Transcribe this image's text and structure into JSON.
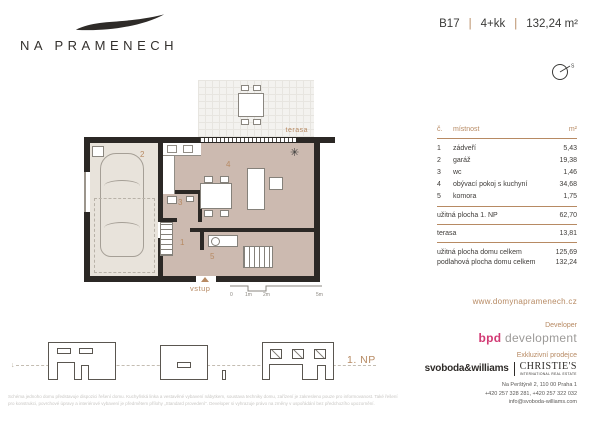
{
  "colors": {
    "accent": "#b78a63",
    "dark_text": "#3a3a38",
    "wall": "#2b2825",
    "floor_living": "#ccbab0",
    "floor_garage": "#e8e3db",
    "bpd_pink": "#d23a74",
    "gray_text": "#9c9a98"
  },
  "header": {
    "logo_text": "NA PRAMENECH",
    "unit": "B17",
    "sep": "|",
    "layout": "4+kk",
    "area": "132,24 m²",
    "compass_north": "S"
  },
  "floor_plan": {
    "terrace_label": "terasa",
    "entrance_label": "vstup",
    "room_numbers": [
      "1",
      "2",
      "3",
      "4",
      "5"
    ],
    "scale_labels": [
      "0",
      "1m",
      "2m",
      "5m"
    ]
  },
  "room_table": {
    "headers": {
      "number": "č.",
      "name": "místnost",
      "area": "m²"
    },
    "rows": [
      {
        "number": "1",
        "name": "zádveří",
        "area": "5,43"
      },
      {
        "number": "2",
        "name": "garáž",
        "area": "19,38"
      },
      {
        "number": "3",
        "name": "wc",
        "area": "1,46"
      },
      {
        "number": "4",
        "name": "obývací pokoj s kuchyní",
        "area": "34,68"
      },
      {
        "number": "5",
        "name": "komora",
        "area": "1,75"
      }
    ],
    "subtotal_np": {
      "name": "užitná plocha 1. NP",
      "area": "62,70"
    },
    "subtotal_terrace": {
      "name": "terasa",
      "area": "13,81"
    },
    "total_usable": {
      "name": "užitná plocha domu celkem",
      "area": "125,69"
    },
    "total_floor": {
      "name": "podlahová plocha domu celkem",
      "area": "132,24"
    }
  },
  "elevations": {
    "floor_label": "1. NP"
  },
  "footer": {
    "website": "www.domynapramenech.cz",
    "developer_label": "Developer",
    "developer_bpd": "bpd",
    "developer_rest": " development",
    "seller_label": "Exkluzivní prodejce",
    "seller_sw": "svoboda&williams",
    "seller_christies": "CHRISTIE'S",
    "seller_christies_sub": "INTERNATIONAL REAL ESTATE",
    "address": "Na Perštýně 2, 110 00 Praha 1",
    "phones": "+420 257 328 281, +420 257 322 032",
    "email": "info@svoboda-williams.com"
  },
  "disclaimer": {
    "line1": "Schéma jednoho domu představuje dispozici řešení domu. Kuchyňská linka a vestavěné vybavení nábytkem, soustava techniky domu, zařízení je zakresleno pouze pro informovanost. Také řešení",
    "line2": "pro konstrukci, povrchové úpravy a interiérové vybavení je předmětem přílohy „Standard provedení“. Developer si vyhrazuje právo na změny v uspořádání bez předchozího upozornění."
  }
}
